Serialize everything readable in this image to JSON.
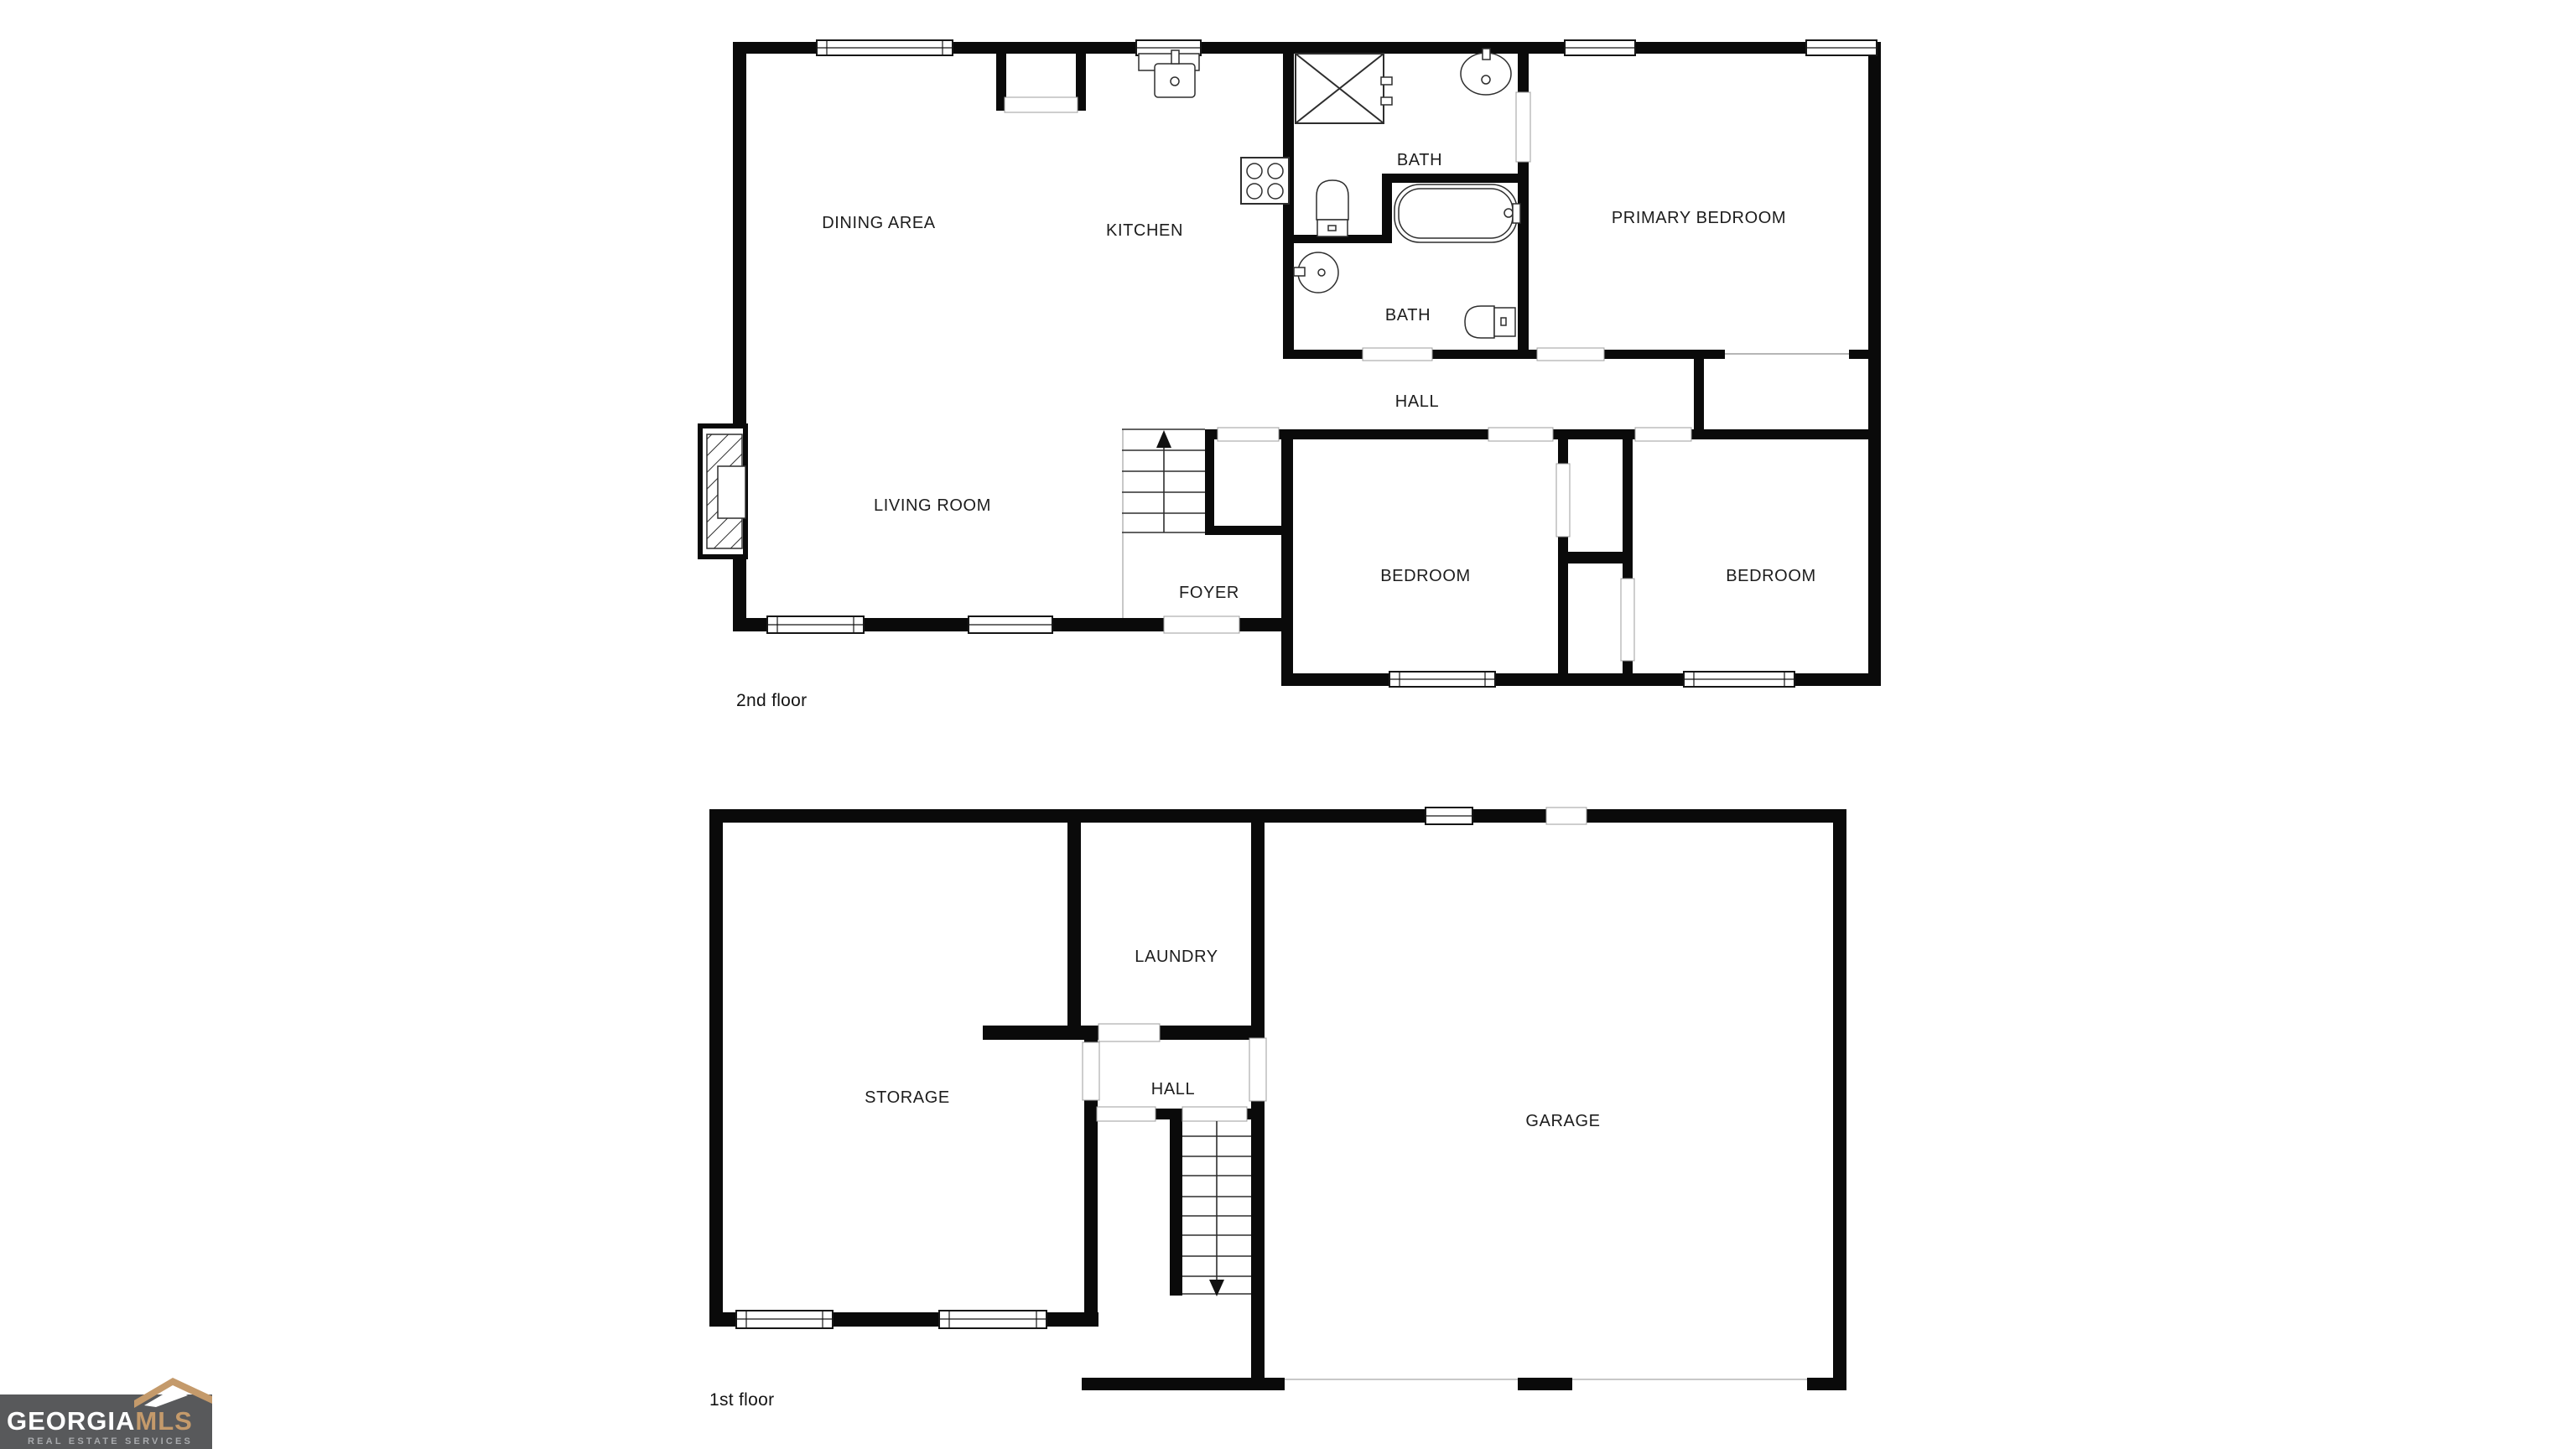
{
  "colors": {
    "background": "#ffffff",
    "walls": "#0a0a0a",
    "thin_line": "#9e9e9e",
    "label_text": "#1d1d1d",
    "logo_background": "#58595b",
    "logo_gold": "#c49a6b",
    "logo_white": "#ffffff",
    "logo_tagline_gray": "#a8aaad"
  },
  "floors": [
    {
      "name": "2nd floor",
      "rooms": [
        {
          "label": "DINING AREA"
        },
        {
          "label": "KITCHEN"
        },
        {
          "label": "BATH"
        },
        {
          "label": "PRIMARY BEDROOM"
        },
        {
          "label": "BATH"
        },
        {
          "label": "HALL"
        },
        {
          "label": "LIVING ROOM"
        },
        {
          "label": "FOYER"
        },
        {
          "label": "BEDROOM"
        },
        {
          "label": "BEDROOM"
        }
      ]
    },
    {
      "name": "1st floor",
      "rooms": [
        {
          "label": "LAUNDRY"
        },
        {
          "label": "STORAGE"
        },
        {
          "label": "HALL"
        },
        {
          "label": "GARAGE"
        }
      ]
    }
  ],
  "logo": {
    "brand": "GEORGIA",
    "brand_suffix": "MLS",
    "tagline": "REAL ESTATE SERVICES"
  }
}
